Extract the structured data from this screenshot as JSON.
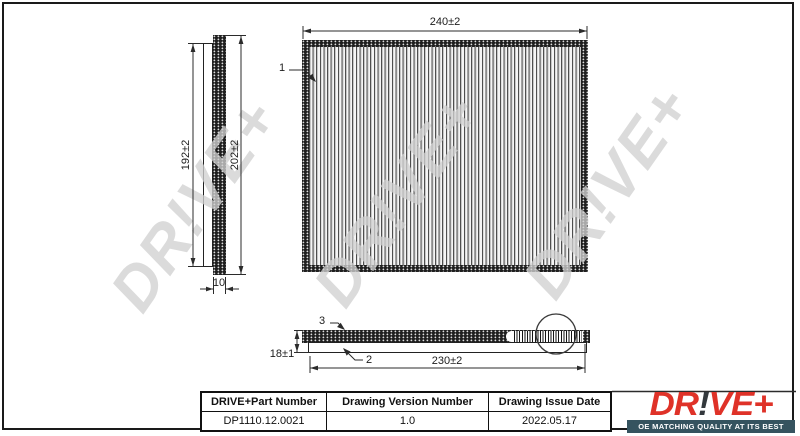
{
  "watermark": {
    "text": "DR!VE+"
  },
  "views": {
    "callout_1": "1",
    "callout_2": "2",
    "callout_3": "3",
    "dim_top_width": "240±2",
    "dim_left_height_inner": "192±2",
    "dim_left_height_outer": "202±2",
    "dim_left_depth": "10",
    "dim_side_thickness": "18±1",
    "dim_side_length": "230±2"
  },
  "table": {
    "headers": [
      "DRIVE+Part Number",
      "Drawing Version Number",
      "Drawing Issue Date"
    ],
    "row": [
      "DP1110.12.0021",
      "1.0",
      "2022.05.17"
    ]
  },
  "logo": {
    "brand_prefix": "DR",
    "brand_bang": "!",
    "brand_suffix": "VE+",
    "tagline": "OE MATCHING QUALITY AT ITS BEST",
    "brand_color": "#df3228",
    "bang_color": "#33383c",
    "tagline_bg": "#35535f"
  }
}
